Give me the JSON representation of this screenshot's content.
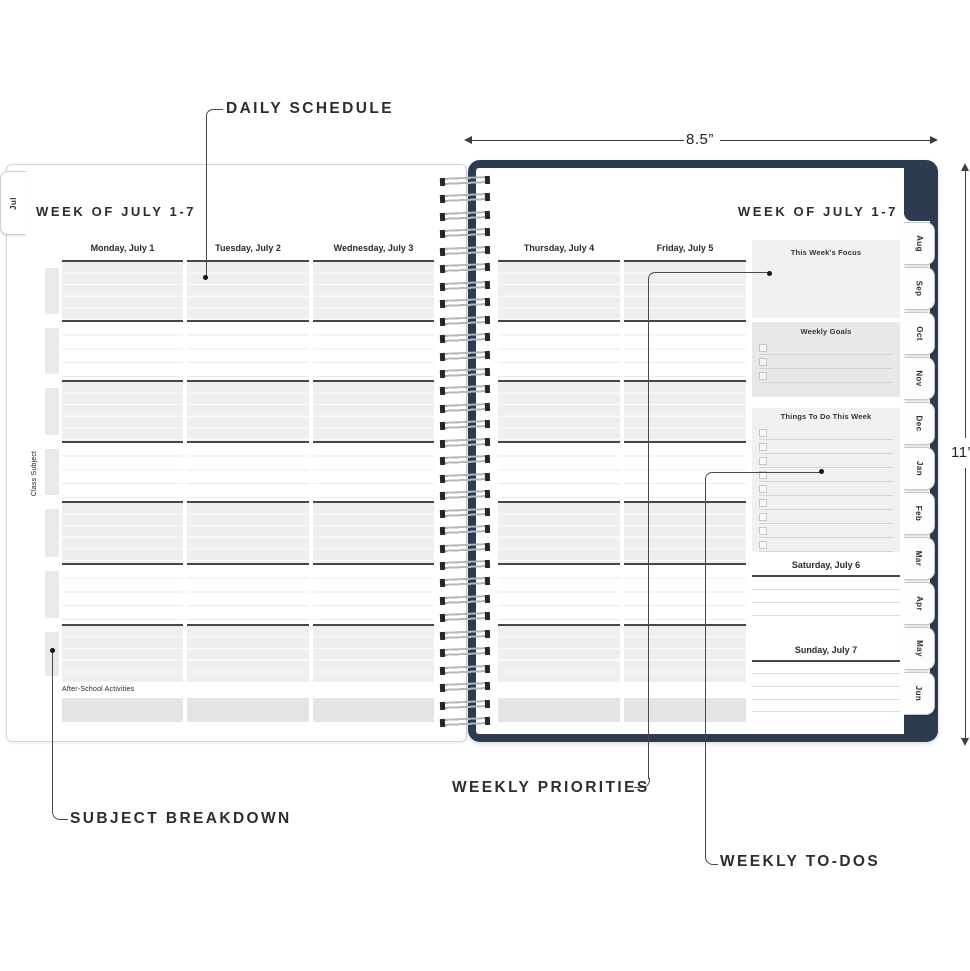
{
  "annotations": {
    "daily_schedule": "DAILY SCHEDULE",
    "subject_breakdown": "SUBJECT BREAKDOWN",
    "weekly_priorities": "WEEKLY PRIORITIES",
    "weekly_todos": "WEEKLY TO-DOS"
  },
  "dimensions": {
    "width_label": "8.5”",
    "height_label": "11”"
  },
  "left_page": {
    "month_tab": "Jul",
    "title": "WEEK OF JULY 1-7",
    "day_headers": [
      "Monday, July 1",
      "Tuesday, July 2",
      "Wednesday, July 3"
    ],
    "side_label": "Class Subject",
    "footer_label": "After-School Activities"
  },
  "right_page": {
    "title": "WEEK OF JULY 1-7",
    "day_headers": [
      "Thursday, July 4",
      "Friday, July 5"
    ],
    "sidebar": {
      "focus_title": "This Week's Focus",
      "goals_title": "Weekly Goals",
      "goals_checkbox_rows": 3,
      "todos_title": "Things To Do This Week",
      "todos_checkbox_rows": 9,
      "saturday_title": "Saturday, July 6",
      "sunday_title": "Sunday, July 7"
    },
    "month_tabs": [
      "Aug",
      "Sep",
      "Oct",
      "Nov",
      "Dec",
      "Jan",
      "Feb",
      "Mar",
      "Apr",
      "May",
      "Jun"
    ]
  },
  "colors": {
    "cover_navy": "#2d3b50",
    "shaded_block": "#eef0ef",
    "sidebar_box_light": "#f0f2f1",
    "sidebar_box_dark": "#e7e9e8",
    "bottom_band": "#e3e5e4",
    "separator_dark": "#474747",
    "callout_line": "#4a4a4a",
    "text_dark": "#2b2b2b"
  }
}
